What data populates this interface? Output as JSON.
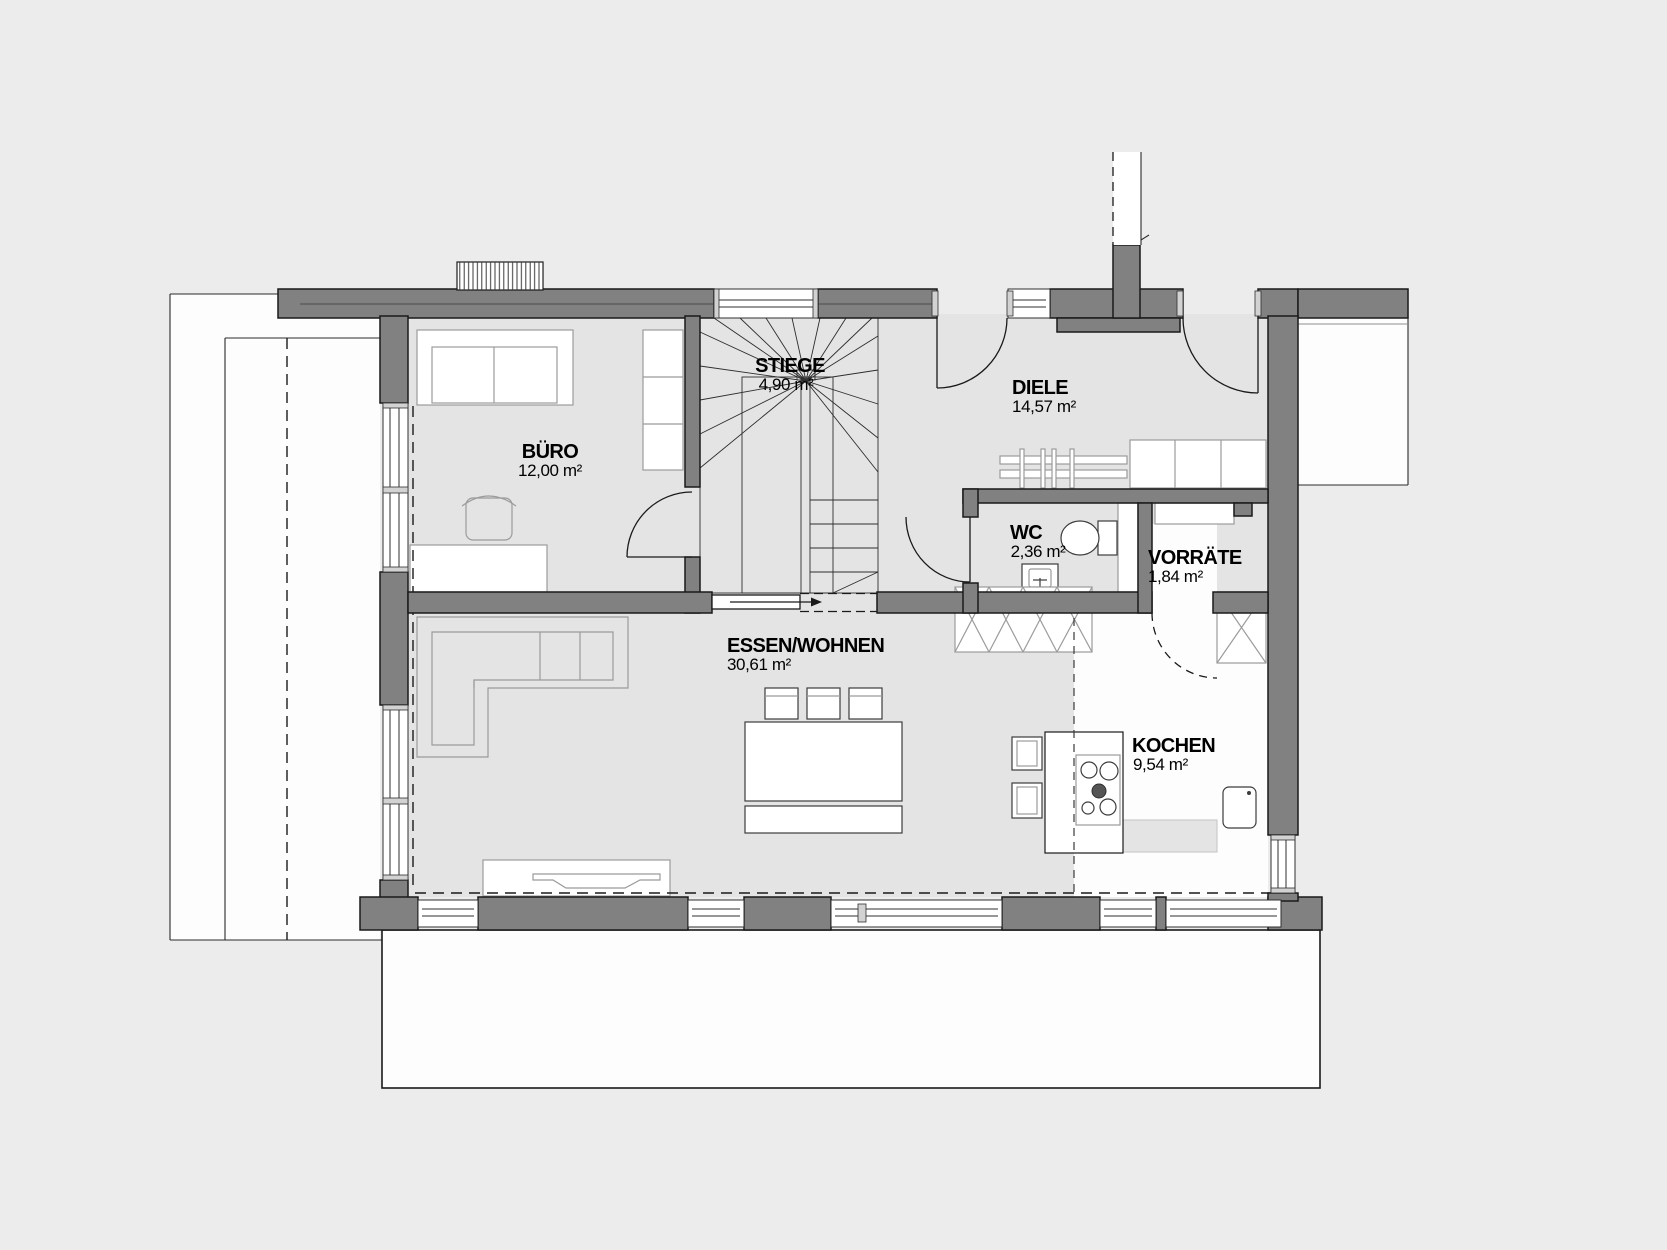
{
  "plan": {
    "rooms": {
      "buero": {
        "name": "BÜRO",
        "area": "12,00 m²"
      },
      "stiege": {
        "name": "STIEGE",
        "area": "4,90 m²"
      },
      "diele": {
        "name": "DIELE",
        "area": "14,57 m²"
      },
      "wc": {
        "name": "WC",
        "area": "2,36 m²"
      },
      "vorraete": {
        "name": "VORRÄTE",
        "area": "1,84 m²"
      },
      "essen": {
        "name": "ESSEN/WOHNEN",
        "area": "30,61 m²"
      },
      "kochen": {
        "name": "KOCHEN",
        "area": "9,54 m²"
      }
    },
    "colors": {
      "background": "#ececec",
      "floor": "#e4e4e4",
      "wall": "#818181",
      "line": "#1a1a1a",
      "furniture": "#9b9b9b"
    }
  }
}
